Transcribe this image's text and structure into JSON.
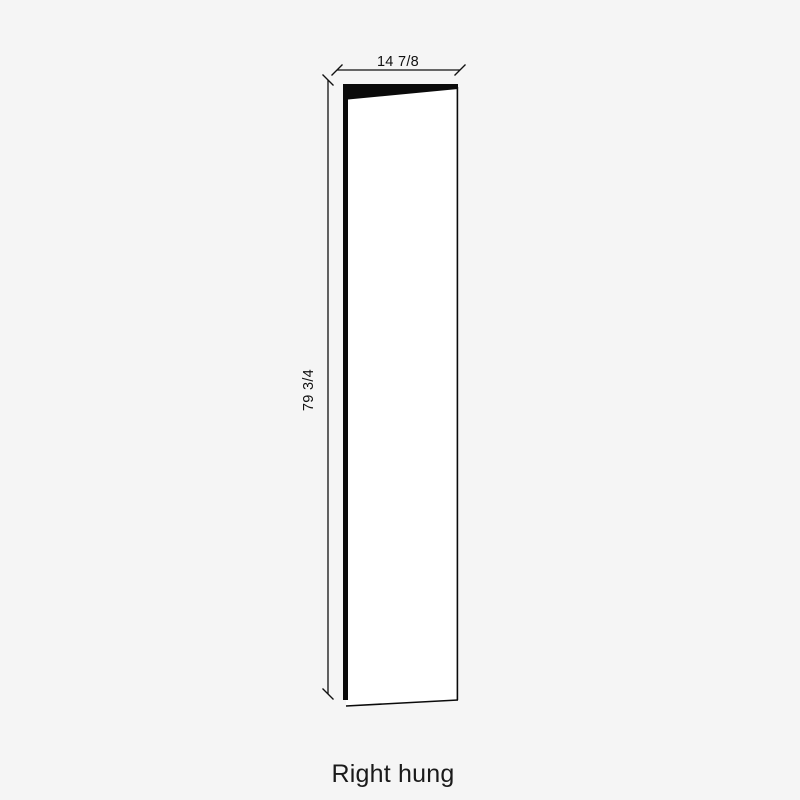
{
  "diagram": {
    "title": "Door panel dimension drawing",
    "width_label": "14 7/8",
    "height_label": "79 3/4",
    "caption": "Right hung",
    "hinge_side": "right",
    "colors": {
      "background": "#f5f5f5",
      "door_face": "#ffffff",
      "line": "#111111",
      "edge_fill": "#0a0a0a"
    }
  }
}
